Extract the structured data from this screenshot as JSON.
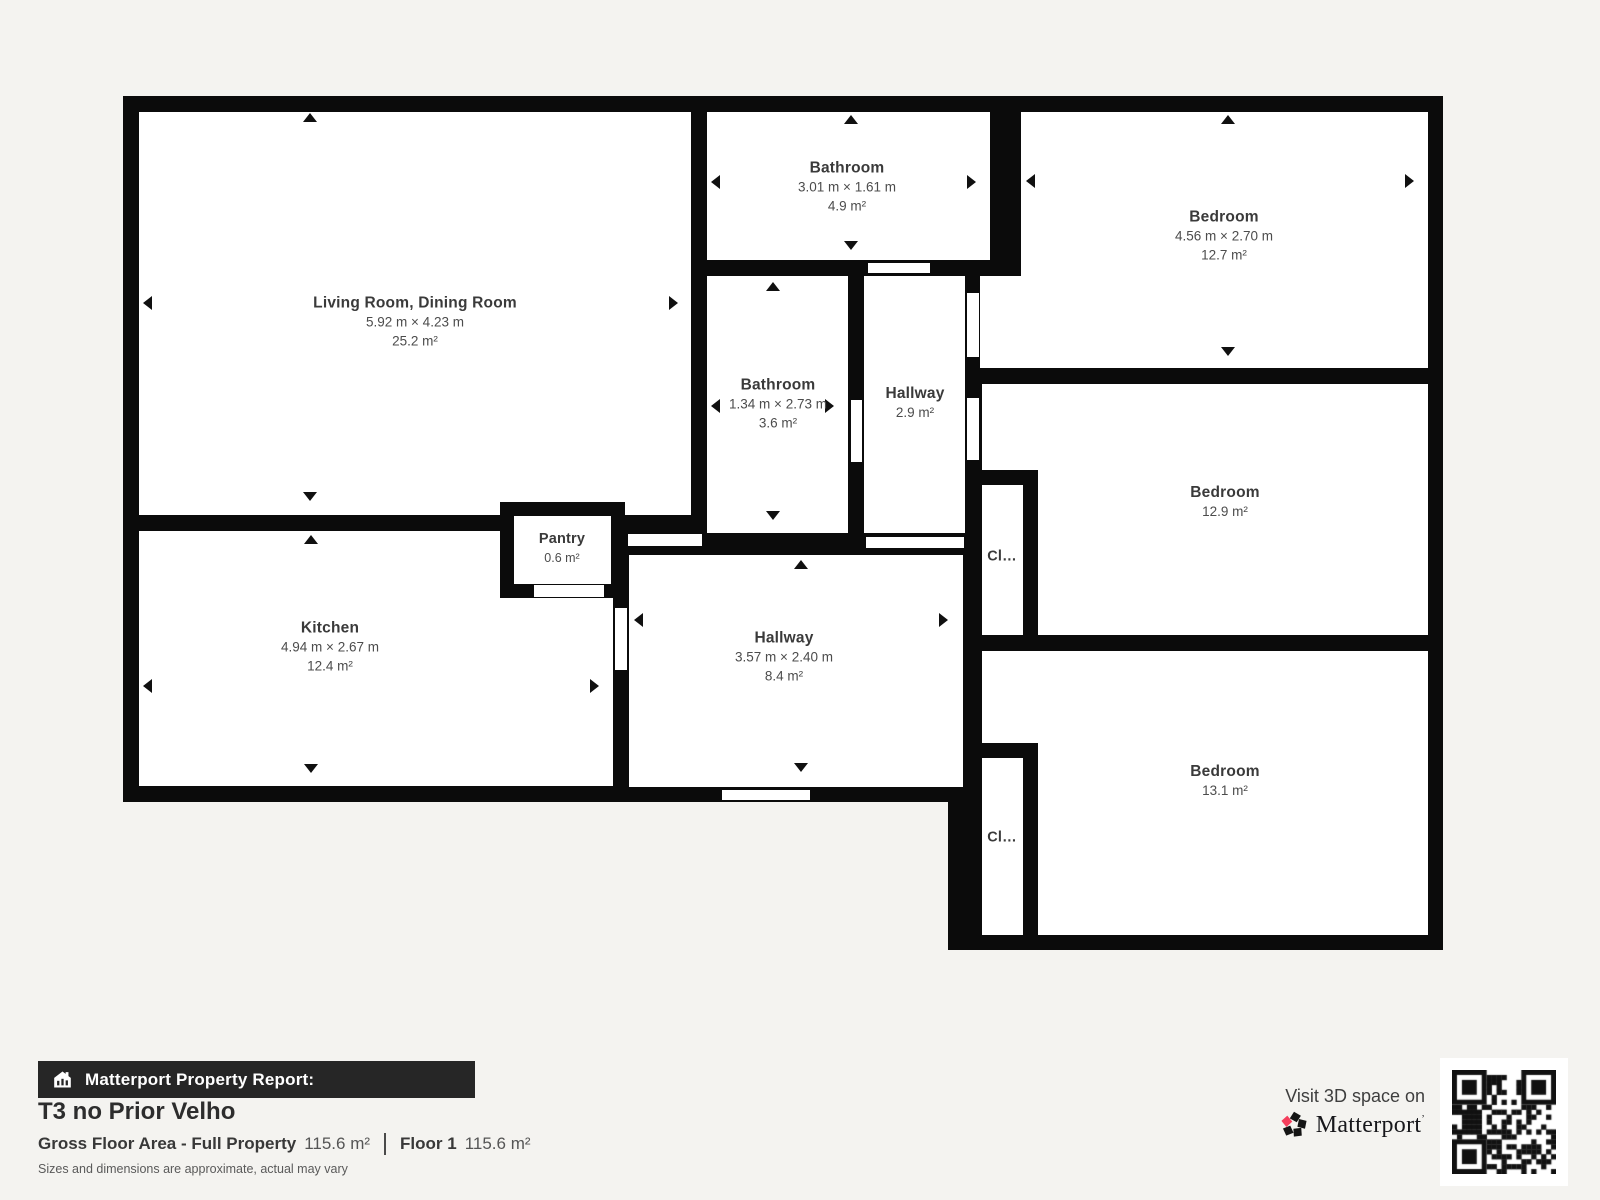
{
  "colors": {
    "background": "#f4f3f0",
    "wall": "#0b0b0b",
    "room_fill": "#ffffff",
    "label_dark": "#3a3a3a",
    "report_bar_bg": "#262626",
    "matterport_pink": "#f43e5c"
  },
  "rooms": [
    {
      "name": "Living Room, Dining Room",
      "dims": "5.92 m × 4.23 m",
      "area": "25.2 m²"
    },
    {
      "name": "Bathroom",
      "dims": "3.01 m × 1.61 m",
      "area": "4.9 m²"
    },
    {
      "name": "Bedroom",
      "dims": "4.56 m × 2.70 m",
      "area": "12.7 m²"
    },
    {
      "name": "Bathroom",
      "dims": "1.34 m × 2.73 m",
      "area": "3.6 m²"
    },
    {
      "name": "Hallway",
      "dims": "",
      "area": "2.9 m²"
    },
    {
      "name": "Bedroom",
      "dims": "",
      "area": "12.9 m²"
    },
    {
      "name": "Kitchen",
      "dims": "4.94 m × 2.67 m",
      "area": "12.4 m²"
    },
    {
      "name": "Pantry",
      "dims": "",
      "area": "0.6 m²"
    },
    {
      "name": "Hallway",
      "dims": "3.57 m × 2.40 m",
      "area": "8.4 m²"
    },
    {
      "name": "Bedroom",
      "dims": "",
      "area": "13.1 m²"
    },
    {
      "name": "Cl…"
    },
    {
      "name": "Cl…"
    }
  ],
  "report": {
    "bar_label": "Matterport Property Report:",
    "title": "T3 no Prior Velho",
    "gfa_label": "Gross Floor Area - Full Property",
    "gfa_value": "115.6 m²",
    "floor_label": "Floor 1",
    "floor_value": "115.6 m²",
    "disclaimer": "Sizes and dimensions are approximate, actual may vary"
  },
  "footer_right": {
    "visit_text": "Visit 3D space on",
    "brand": "Matterport",
    "brand_mark": "ʼ"
  }
}
